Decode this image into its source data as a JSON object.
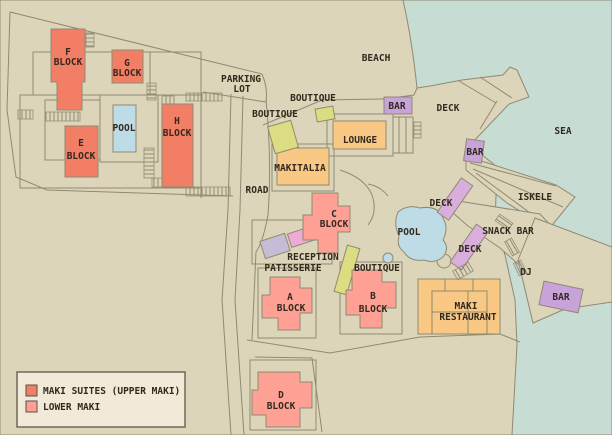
{
  "map": {
    "title": "resort site map",
    "palette": {
      "land": "#ddd5ba",
      "sea": "#c7dcd3",
      "outline": "#8f8a72",
      "upper_maki": "#f37e66",
      "lower_maki": "#fea093",
      "amenity_orange": "#f8c884",
      "boutique_yellow": "#dcdc82",
      "bar_purple": "#c8a3d9",
      "deck_purple": "#d9aedd",
      "lavender": "#c5bcd6",
      "pink": "#f0aad6",
      "pool_blue": "#bedce6",
      "text": "#33291f",
      "legend_bg": "#f1ead8",
      "legend_border": "#6f6a58"
    },
    "labels": {
      "beach": "BEACH",
      "sea": "SEA",
      "parking_line1": "PARKING",
      "parking_line2": "LOT",
      "road": "ROAD",
      "pool_left": "POOL",
      "pool_center": "POOL",
      "boutique_top": "BOUTIQUE",
      "boutique_mid": "BOUTIQUE",
      "boutique_lower": "BOUTIQUE",
      "bar_top": "BAR",
      "bar_mid": "BAR",
      "bar_bottom": "BAR",
      "deck_top": "DECK",
      "deck_mid": "DECK",
      "deck_lower": "DECK",
      "lounge": "LOUNGE",
      "makitalia": "MAKITALIA",
      "iskele": "ISKELE",
      "snack_bar": "SNACK BAR",
      "dj": "DJ",
      "reception": "RECEPTION",
      "patisserie": "PATISSERIE",
      "restaurant_line1": "MAKI",
      "restaurant_line2": "RESTAURANT",
      "f": "F",
      "g": "G",
      "e": "E",
      "h": "H",
      "a": "A",
      "b": "B",
      "c": "C",
      "d": "D",
      "block_word": "BLOCK"
    },
    "legend": {
      "items": [
        {
          "label": "MAKI SUITES (UPPER MAKI)",
          "color": "#f37e66"
        },
        {
          "label": "LOWER MAKI",
          "color": "#fea093"
        }
      ]
    }
  }
}
